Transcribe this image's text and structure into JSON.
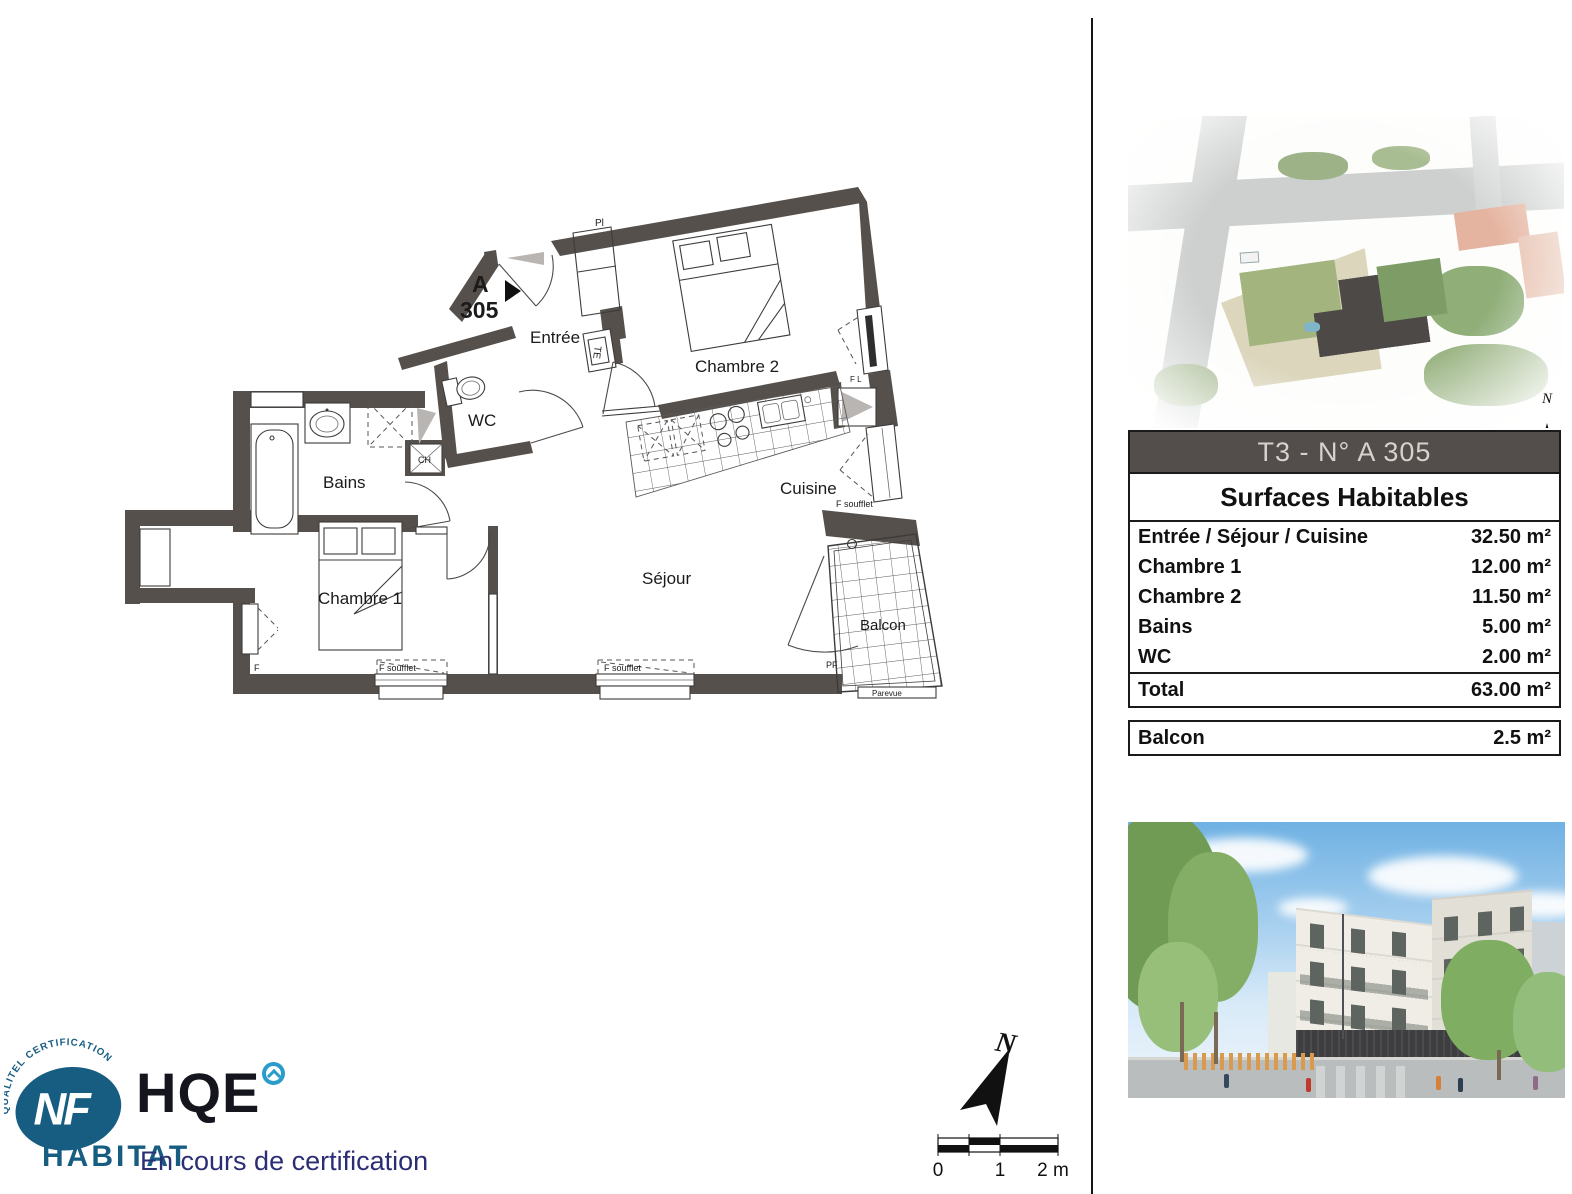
{
  "plan": {
    "unit": {
      "letter": "A",
      "number": "305"
    },
    "rooms": {
      "entree": "Entrée",
      "chambre2": "Chambre 2",
      "wc": "WC",
      "bains": "Bains",
      "chambre1": "Chambre 1",
      "cuisine": "Cuisine",
      "sejour": "Séjour",
      "balcon": "Balcon"
    },
    "annotations": {
      "pl": "Pl",
      "te": "TE",
      "ch": "CH",
      "f": "F",
      "f_soufflet": "F soufflet",
      "f_l": "F L",
      "pf": "PF",
      "parevue": "Parevue"
    }
  },
  "compass": {
    "north": "N"
  },
  "scalebar": {
    "zero": "0",
    "one": "1",
    "two": "2 m"
  },
  "site_plan": {
    "north": "N"
  },
  "logo": {
    "arc_text": "QUALITEL CERTIFICATION",
    "nf": "NF",
    "hqe": "HQE",
    "habitat": "HABITAT",
    "status": "En cours de certification"
  },
  "table": {
    "title": "T3  - N° A 305",
    "subtitle": "Surfaces Habitables",
    "rows": [
      {
        "label": "Entrée / Séjour / Cuisine",
        "value": "32.50 m²"
      },
      {
        "label": "Chambre 1",
        "value": "12.00 m²"
      },
      {
        "label": "Chambre 2",
        "value": "11.50 m²"
      },
      {
        "label": "Bains",
        "value": "5.00 m²"
      },
      {
        "label": "WC",
        "value": "2.00 m²"
      }
    ],
    "total": {
      "label": "Total",
      "value": "63.00 m²"
    },
    "balcony": {
      "label": "Balcon",
      "value": "2.5 m²"
    },
    "colors": {
      "header_bg": "#534d4b",
      "header_text": "#d8d2cc",
      "wall": "#56504c",
      "logo_blue": "#175d82"
    }
  }
}
